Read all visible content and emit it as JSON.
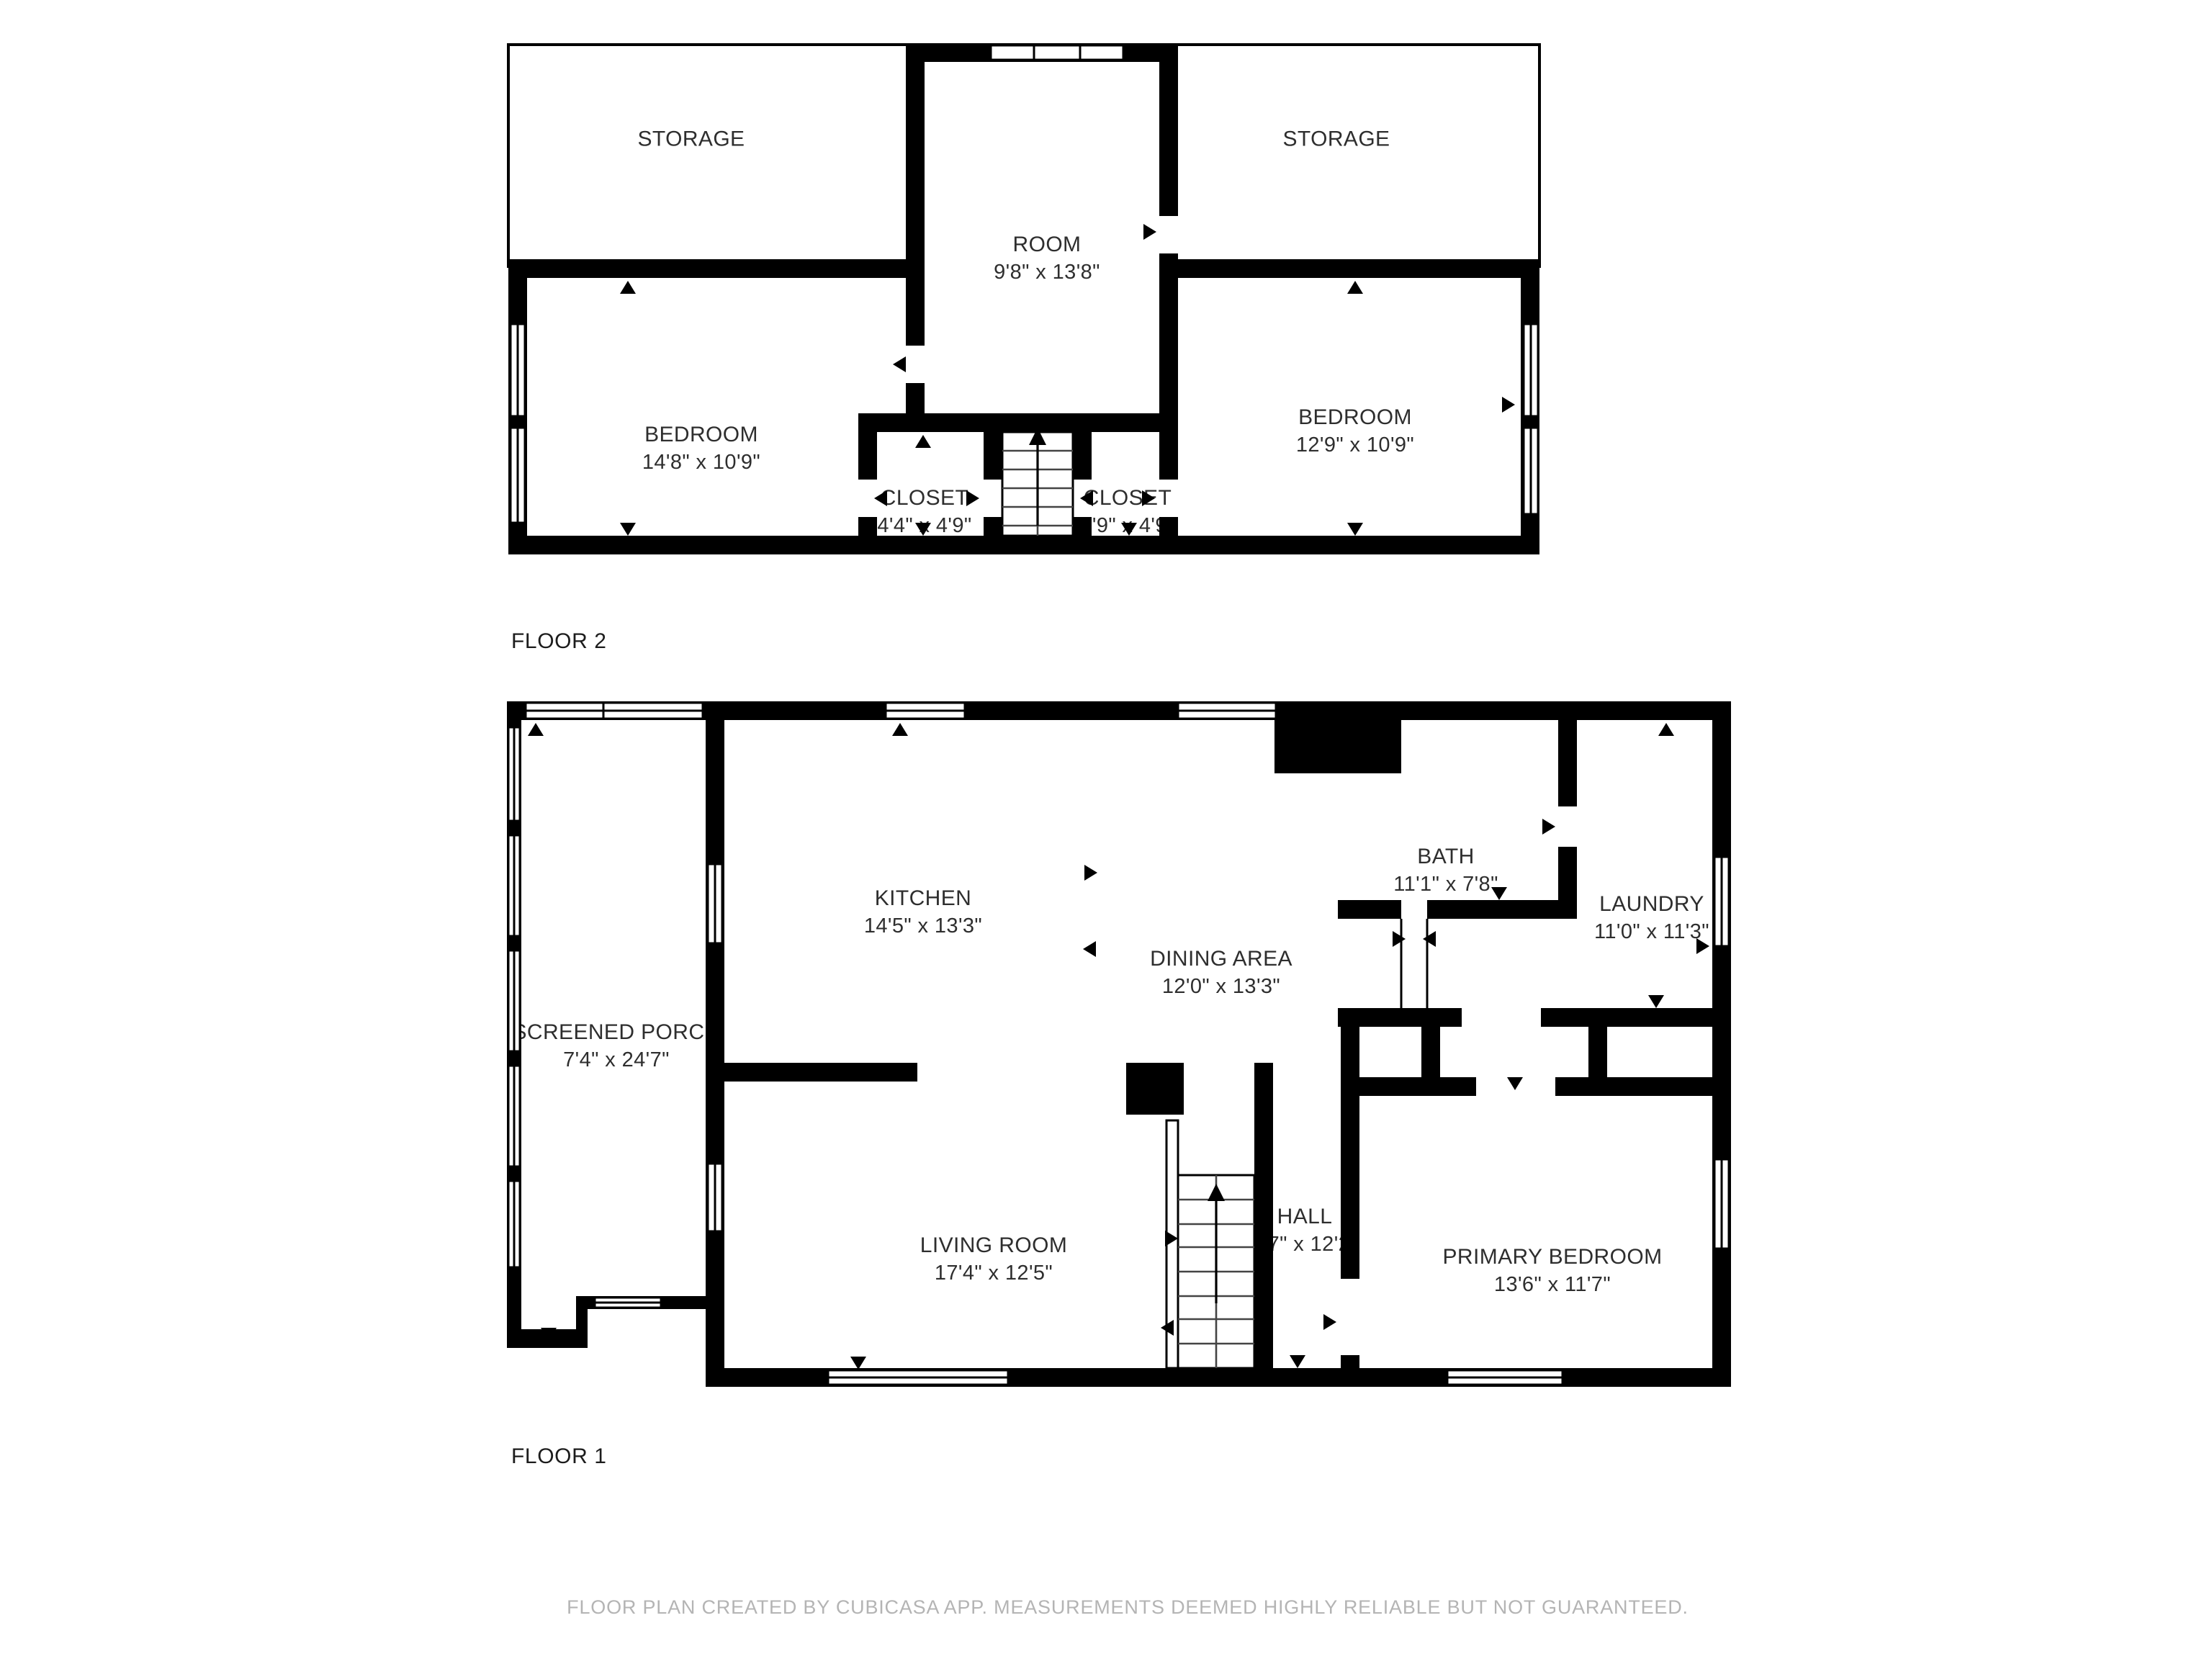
{
  "floor2": {
    "label": "FLOOR 2",
    "rooms": {
      "storage_left": {
        "label": "STORAGE"
      },
      "storage_right": {
        "label": "STORAGE"
      },
      "room": {
        "label": "ROOM",
        "dims": "9'8\" x 13'8\""
      },
      "bedroom_left": {
        "label": "BEDROOM",
        "dims": "14'8\" x 10'9\""
      },
      "bedroom_right": {
        "label": "BEDROOM",
        "dims": "12'9\" x 10'9\""
      },
      "closet_left": {
        "label": "CLOSET",
        "dims": "4'4\" x 4'9\""
      },
      "closet_right": {
        "label": "CLOSET",
        "dims": "3'9\" x 4'9\""
      }
    }
  },
  "floor1": {
    "label": "FLOOR 1",
    "rooms": {
      "kitchen": {
        "label": "KITCHEN",
        "dims": "14'5\" x 13'3\""
      },
      "dining": {
        "label": "DINING AREA",
        "dims": "12'0\" x 13'3\""
      },
      "bath": {
        "label": "BATH",
        "dims": "11'1\" x 7'8\""
      },
      "laundry": {
        "label": "LAUNDRY",
        "dims": "11'0\" x 11'3\""
      },
      "porch": {
        "label": "SCREENED PORCH",
        "dims": "7'4\" x 24'7\""
      },
      "living": {
        "label": "LIVING ROOM",
        "dims": "17'4\" x 12'5\""
      },
      "hall": {
        "label": "HALL",
        "dims": "5'7\" x 12'2\""
      },
      "primary": {
        "label": "PRIMARY BEDROOM",
        "dims": "13'6\" x 11'7\""
      }
    }
  },
  "footer": {
    "text": "FLOOR PLAN CREATED BY CUBICASA APP. MEASUREMENTS DEEMED HIGHLY RELIABLE BUT NOT GUARANTEED."
  },
  "colors": {
    "wall": "#000000",
    "label_text": "#2e2e2e",
    "footer_text": "#b4b4b4"
  }
}
